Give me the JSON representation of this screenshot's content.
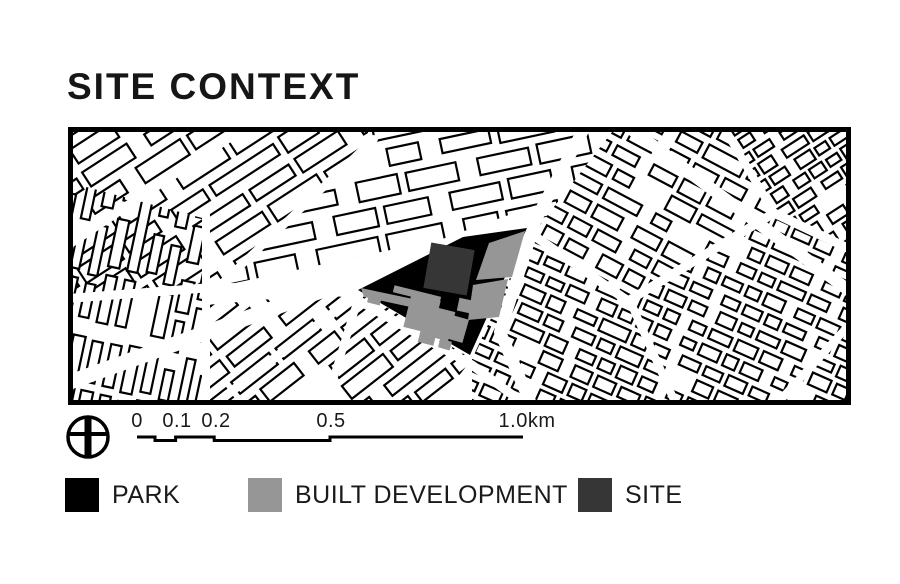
{
  "header": {
    "title": "SITE CONTEXT"
  },
  "map": {
    "frame_color": "#000000",
    "background": "#ffffff",
    "building_fill": "#ffffff",
    "building_stroke": "#000000",
    "street_color": "#ffffff",
    "park_color": "#000000",
    "built_color": "#969696",
    "site_color": "#363636",
    "park_polygon": [
      [
        290,
        163
      ],
      [
        395,
        110
      ],
      [
        459,
        101
      ],
      [
        402,
        228
      ]
    ],
    "site_shape": {
      "x": 359,
      "y": 119,
      "w": 44,
      "h": 46,
      "rot": 10
    },
    "built_shapes": [
      {
        "points": [
          [
            421,
            116
          ],
          [
            457,
            104
          ],
          [
            444,
            150
          ],
          [
            408,
            153
          ]
        ]
      },
      {
        "points": [
          [
            405,
            158
          ],
          [
            440,
            152
          ],
          [
            431,
            190
          ],
          [
            400,
            193
          ]
        ]
      },
      {
        "points": [
          [
            293,
            161
          ],
          [
            345,
            172
          ],
          [
            347,
            181
          ],
          [
            296,
            170
          ]
        ]
      },
      {
        "rect": [
          339,
          170,
          30,
          34,
          14
        ]
      },
      {
        "rect": [
          362,
          182,
          22,
          30,
          14
        ]
      },
      {
        "rect": [
          325,
          164,
          48,
          7,
          14
        ]
      },
      {
        "rect": [
          381,
          190,
          17,
          24,
          16
        ]
      },
      {
        "rect": [
          351,
          205,
          16,
          12,
          14
        ]
      },
      {
        "rect": [
          371,
          213,
          12,
          9,
          16
        ]
      },
      {
        "rect": [
          390,
          172,
          13,
          13,
          12
        ]
      },
      {
        "rect": [
          300,
          168,
          13,
          9,
          14
        ]
      }
    ],
    "districts": [
      {
        "clip": [
          [
            0,
            0
          ],
          [
            300,
            0
          ],
          [
            300,
            18
          ],
          [
            145,
            162
          ],
          [
            0,
            172
          ]
        ],
        "tx": -120,
        "ty": 40,
        "rot": -33,
        "rows": 10,
        "cols": 8,
        "cw": 46,
        "ch": 16,
        "gx": 8,
        "gy": 10,
        "se": 3,
        "sg": 12
      },
      {
        "clip": [
          [
            0,
            55
          ],
          [
            138,
            92
          ],
          [
            138,
            278
          ],
          [
            0,
            278
          ]
        ],
        "tx": -50,
        "ty": 290,
        "rot": -78,
        "rows": 10,
        "cols": 6,
        "cw": 40,
        "ch": 11,
        "gx": 9,
        "gy": 8,
        "se": 2,
        "sg": 10
      },
      {
        "clip": [
          [
            138,
            178
          ],
          [
            292,
            164
          ],
          [
            404,
            232
          ],
          [
            368,
            278
          ],
          [
            138,
            278
          ]
        ],
        "tx": 40,
        "ty": 230,
        "rot": -38,
        "rows": 11,
        "cols": 7,
        "cw": 42,
        "ch": 14,
        "gx": 8,
        "gy": 10,
        "se": 3,
        "sg": 11
      },
      {
        "clip": [
          [
            300,
            0
          ],
          [
            548,
            0
          ],
          [
            478,
            90
          ],
          [
            148,
            160
          ],
          [
            300,
            16
          ]
        ],
        "tx": 110,
        "ty": -20,
        "rot": -12,
        "rows": 7,
        "cols": 9,
        "cw": 44,
        "ch": 18,
        "gx": 9,
        "gy": 10,
        "se": 2,
        "sg": 13
      },
      {
        "clip": [
          [
            548,
            0
          ],
          [
            652,
            0
          ],
          [
            704,
            86
          ],
          [
            560,
            176
          ],
          [
            462,
            108
          ],
          [
            478,
            90
          ]
        ],
        "tx": 560,
        "ty": -120,
        "rot": 28,
        "rows": 13,
        "cols": 8,
        "cw": 24,
        "ch": 13,
        "gx": 7,
        "gy": 8,
        "se": 3,
        "sg": 9
      },
      {
        "clip": [
          [
            652,
            0
          ],
          [
            783,
            0
          ],
          [
            783,
            126
          ],
          [
            704,
            86
          ]
        ],
        "tx": 600,
        "ty": 20,
        "rot": -33,
        "rows": 12,
        "cols": 8,
        "cw": 17,
        "ch": 10,
        "gx": 5,
        "gy": 6,
        "se": 4,
        "sg": 7
      },
      {
        "clip": [
          [
            462,
            108
          ],
          [
            560,
            176
          ],
          [
            704,
            86
          ],
          [
            783,
            126
          ],
          [
            783,
            278
          ],
          [
            404,
            278
          ],
          [
            404,
            232
          ]
        ],
        "tx": 500,
        "ty": -40,
        "rot": 24,
        "rows": 19,
        "cols": 17,
        "cw": 18,
        "ch": 11,
        "gx": 6,
        "gy": 7,
        "se": 4,
        "sg": 8
      }
    ],
    "streets": [
      {
        "d": "M -6 258 L 468 86",
        "w": 15
      },
      {
        "d": "M 520 -6 L 468 92 L 432 205 L 466 284",
        "w": 12
      },
      {
        "d": "M 552 -6 L 783 165",
        "w": 12
      },
      {
        "d": "M -6 172 L 150 160 L 292 166",
        "w": 9
      },
      {
        "d": "M 465 108 L 560 174 L 706 86 L 790 126",
        "w": 9
      },
      {
        "d": "M 0 118 L 215 -25",
        "w": 9
      },
      {
        "d": "M 138 284 L 345 124",
        "w": 9
      },
      {
        "d": "M 138 88 L 138 282",
        "w": 8
      },
      {
        "d": "M 148 162 L 306 12",
        "w": 8
      },
      {
        "d": "M 292 166 L 256 282",
        "w": 8
      },
      {
        "d": "M 288 172 L 404 238 L 466 284",
        "w": 9
      },
      {
        "d": "M 652 -6 L 706 86",
        "w": 8
      },
      {
        "d": "M 704 282 L 783 196",
        "w": 8
      },
      {
        "d": "M 562 174 L 610 282",
        "w": 8
      }
    ]
  },
  "scale_bar": {
    "labels": [
      "0",
      "0.1",
      "0.2",
      "0.5",
      "1.0km"
    ]
  },
  "legend": {
    "items": [
      {
        "label": "PARK",
        "color": "#000000"
      },
      {
        "label": "BUILT DEVELOPMENT",
        "color": "#969696"
      },
      {
        "label": "SITE",
        "color": "#363636"
      }
    ]
  }
}
